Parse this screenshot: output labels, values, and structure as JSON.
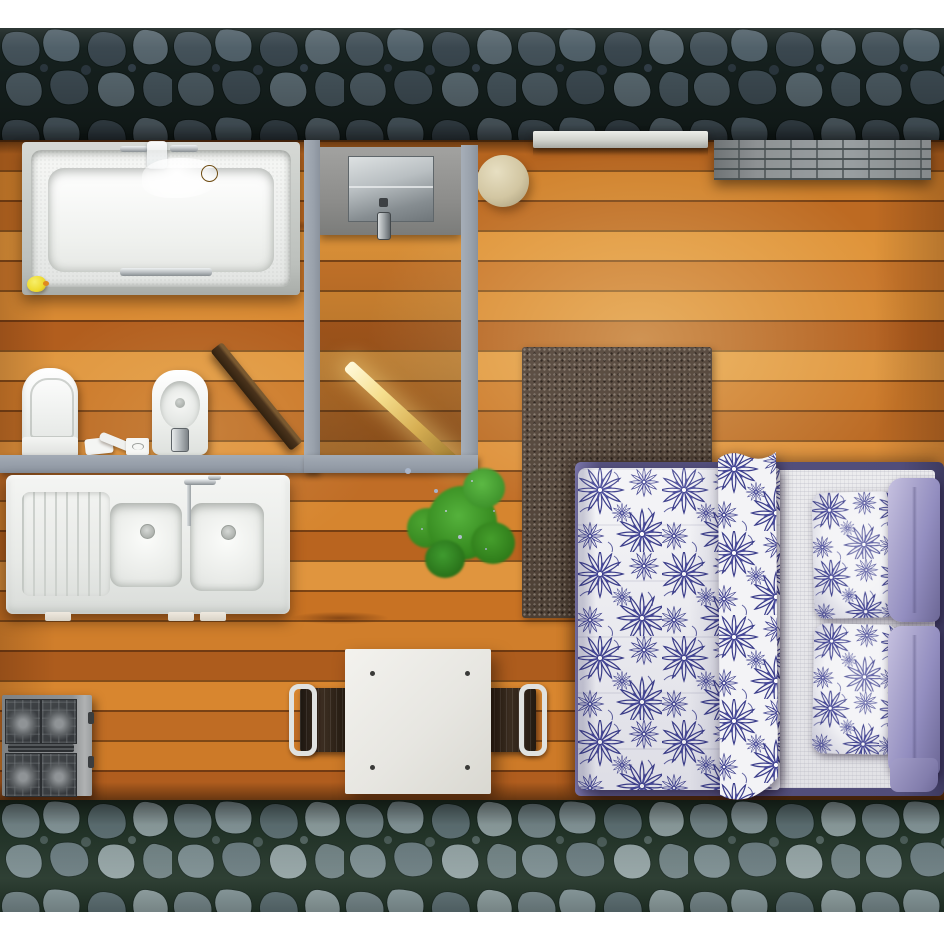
{
  "scene": {
    "type": "3d-rendered-studio-apartment-floor-plan",
    "view": "top-down",
    "rooms": [
      "bathroom",
      "shower-wc-room",
      "kitchen-area",
      "bedroom-living-area"
    ],
    "furniture_and_fixtures": [
      "bathtub with faucet, water, gold drain and rubber duck",
      "toilet",
      "bidet",
      "toilet-paper-holder",
      "toilet-brush",
      "tissue-box",
      "open wooden bathroom door",
      "wall-mounted shower/cistern panel with chrome plate and flush valve",
      "glowing open doorway",
      "double-bowl kitchen sink with drainboard and faucet",
      "four-burner gas cooktop",
      "square white dining table",
      "two dark chairs with metal frames",
      "speckled area rug",
      "potted green plant",
      "double bed with indigo floral duvet and pillows",
      "two lavender pillows",
      "round beige pouf",
      "stone window ledge",
      "gray brick bench"
    ],
    "walls": {
      "top": "dark blue-gray stone wall",
      "bottom": "light gray-green stone wall",
      "interior": "gray partition walls around bathroom and shower room"
    },
    "floor": "orange-brown horizontal wood planks with warm light pool below window",
    "palette": {
      "stone_top": "#44525a",
      "stone_top_mortar": "#16211f",
      "stone_bottom": "#87999c",
      "stone_bottom_mortar": "#223428",
      "partition_wall": "#99a1ab",
      "wood_light": "#e09740",
      "wood_dark": "#ad5c1d",
      "fixture_white": "#f2f3f1",
      "gold_drain": "#c28c2e",
      "duck_yellow": "#eeda2e",
      "door_wood": "#4a331c",
      "doorway_glow": "#f6df8e",
      "cooktop_gray": "#43474a",
      "table_white": "#e7e6e1",
      "chair_seat_brown": "#2c2218",
      "rug_taupe": "#4f4237",
      "plant_green": "#35891f",
      "bedding_indigo": "#3c3e8c",
      "bedding_white": "#f3f3f6",
      "pillow_lavender": "#938ec0",
      "bed_frame_purple": "#514d7a",
      "pouf_beige": "#d2c6a2",
      "bench_brick": "#8e9294",
      "margin_white": "#ffffff"
    }
  }
}
